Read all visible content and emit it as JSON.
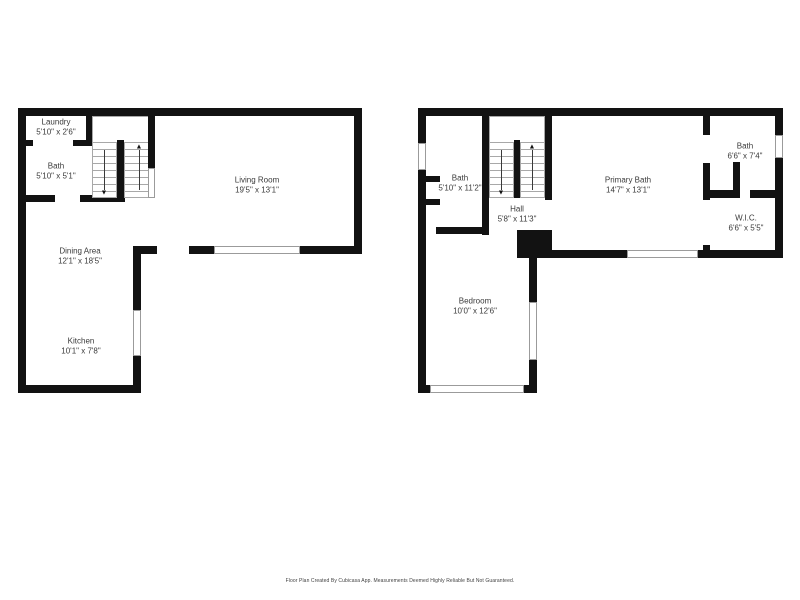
{
  "footer": {
    "text": "Floor Plan Created By Cubicasa App. Measurements Deemed Highly Reliable But Not Guaranteed."
  },
  "colors": {
    "wall": "#121212",
    "text": "#3a3a3a",
    "stair_line": "#a8a8a8",
    "background": "#ffffff"
  },
  "icons": {
    "stairs_up_arrow": "▲",
    "stairs_down_arrow": "▼"
  },
  "floors": [
    {
      "name": "first-floor",
      "rooms": [
        {
          "label": "Laundry",
          "dims": "5'10\" x 2'6\""
        },
        {
          "label": "Bath",
          "dims": "5'10\" x 5'1\""
        },
        {
          "label": "Living Room",
          "dims": "19'5\" x 13'1\""
        },
        {
          "label": "Dining Area",
          "dims": "12'1\" x 18'5\""
        },
        {
          "label": "Kitchen",
          "dims": "10'1\" x 7'8\""
        }
      ]
    },
    {
      "name": "second-floor",
      "rooms": [
        {
          "label": "Bath",
          "dims": "5'10\" x 11'2\""
        },
        {
          "label": "Hall",
          "dims": "5'8\" x 11'3\""
        },
        {
          "label": "Primary Bath",
          "dims": "14'7\" x 13'1\""
        },
        {
          "label": "Bath",
          "dims": "6'6\" x 7'4\""
        },
        {
          "label": "W.I.C.",
          "dims": "6'6\" x 5'5\""
        },
        {
          "label": "Bedroom",
          "dims": "10'0\" x 12'6\""
        }
      ]
    }
  ]
}
